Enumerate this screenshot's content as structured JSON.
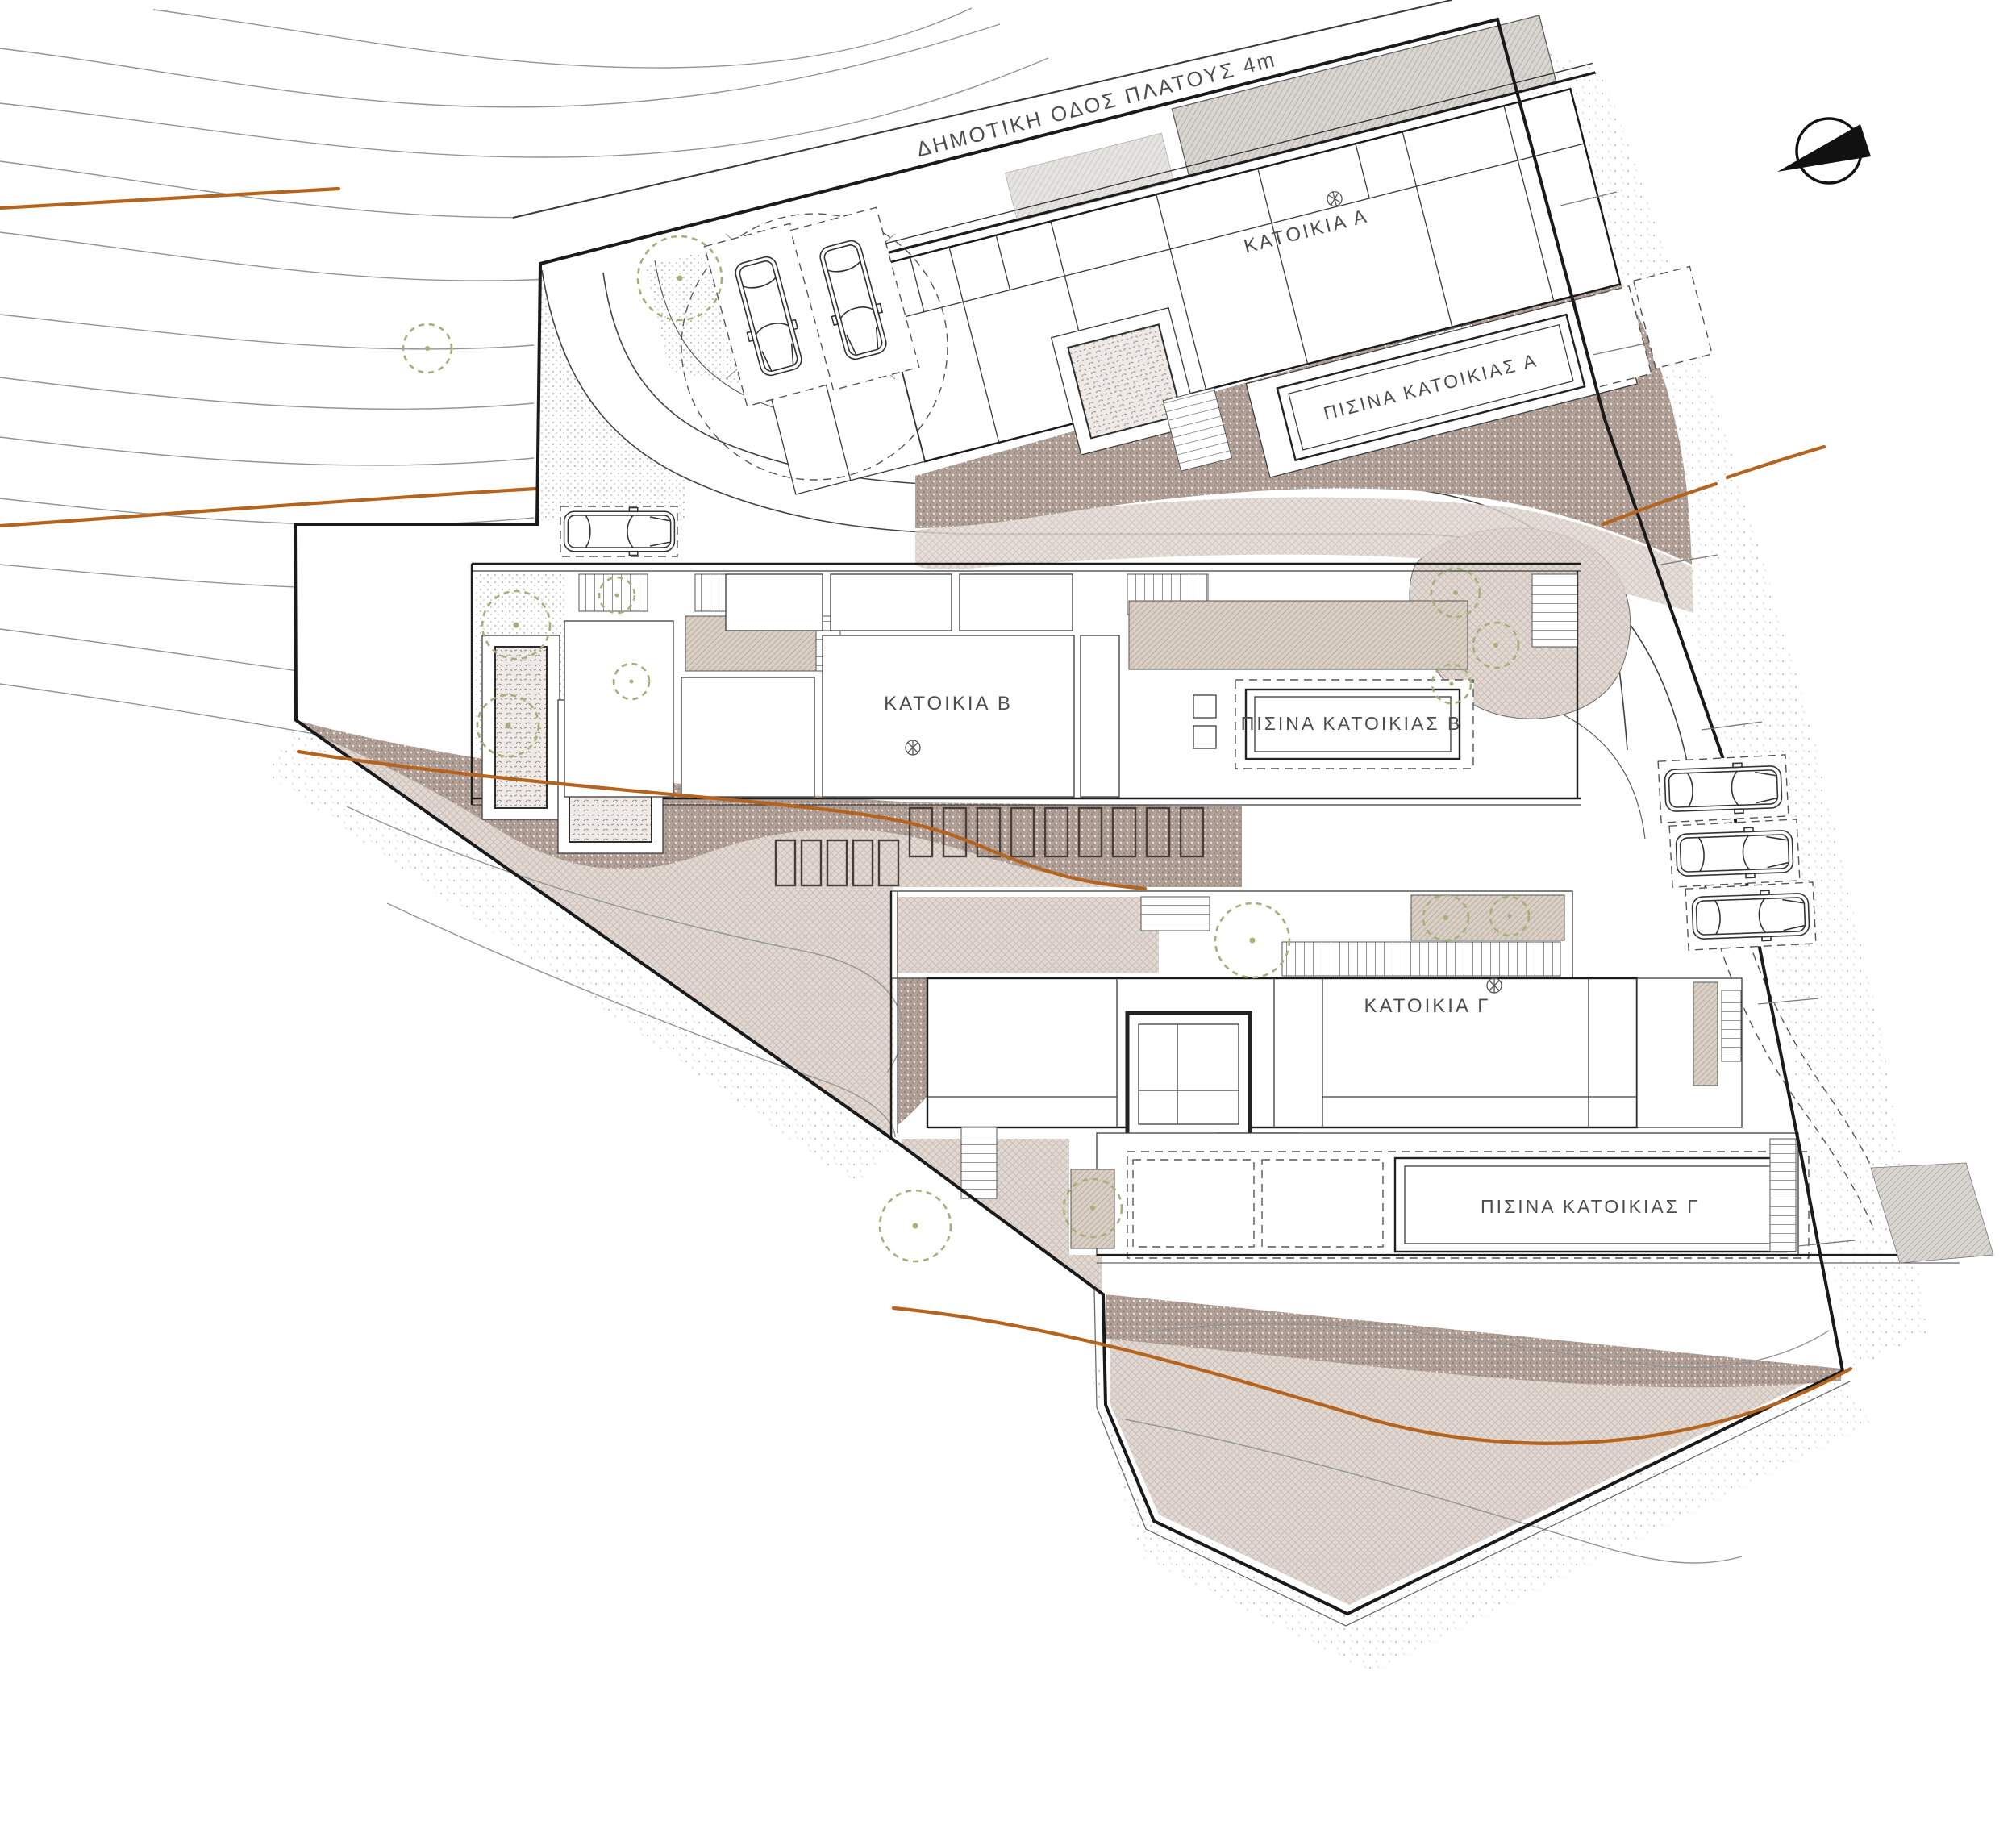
{
  "title": "Architectural site plan – three residences",
  "road": {
    "label": "ΔΗΜΟΤΙΚΗ ΟΔΟΣ ΠΛΑΤΟΥΣ 4m"
  },
  "houses": [
    {
      "id": "A",
      "label": "ΚΑΤΟΙΚΙΑ Α",
      "pool_label": "ΠΙΣΙΝΑ ΚΑΤΟΙΚΙΑΣ Α"
    },
    {
      "id": "B",
      "label": "ΚΑΤΟΙΚΙΑ Β",
      "pool_label": "ΠΙΣΙΝΑ ΚΑΤΟΙΚΙΑΣ Β"
    },
    {
      "id": "C",
      "label": "ΚΑΤΟΙΚΙΑ Γ",
      "pool_label": "ΠΙΣΙΝΑ ΚΑΤΟΙΚΙΑΣ Γ"
    }
  ],
  "icons": {
    "north_arrow": "north-arrow-icon",
    "tree": "tree-icon",
    "car": "car-icon",
    "rosette": "rosette-icon"
  },
  "counts": {
    "cars": 6,
    "trees": 14
  },
  "colors": {
    "line": "#1a1a1a",
    "contour_gray": "#949494",
    "contour_orange": "#b4641e",
    "tree_green": "#a3b077",
    "terrain_dark": "#b1a097",
    "terrain_light": "#e2d9d3",
    "hatch_beige": "#d9cfc4",
    "deck_gray": "#d9d6d2"
  }
}
